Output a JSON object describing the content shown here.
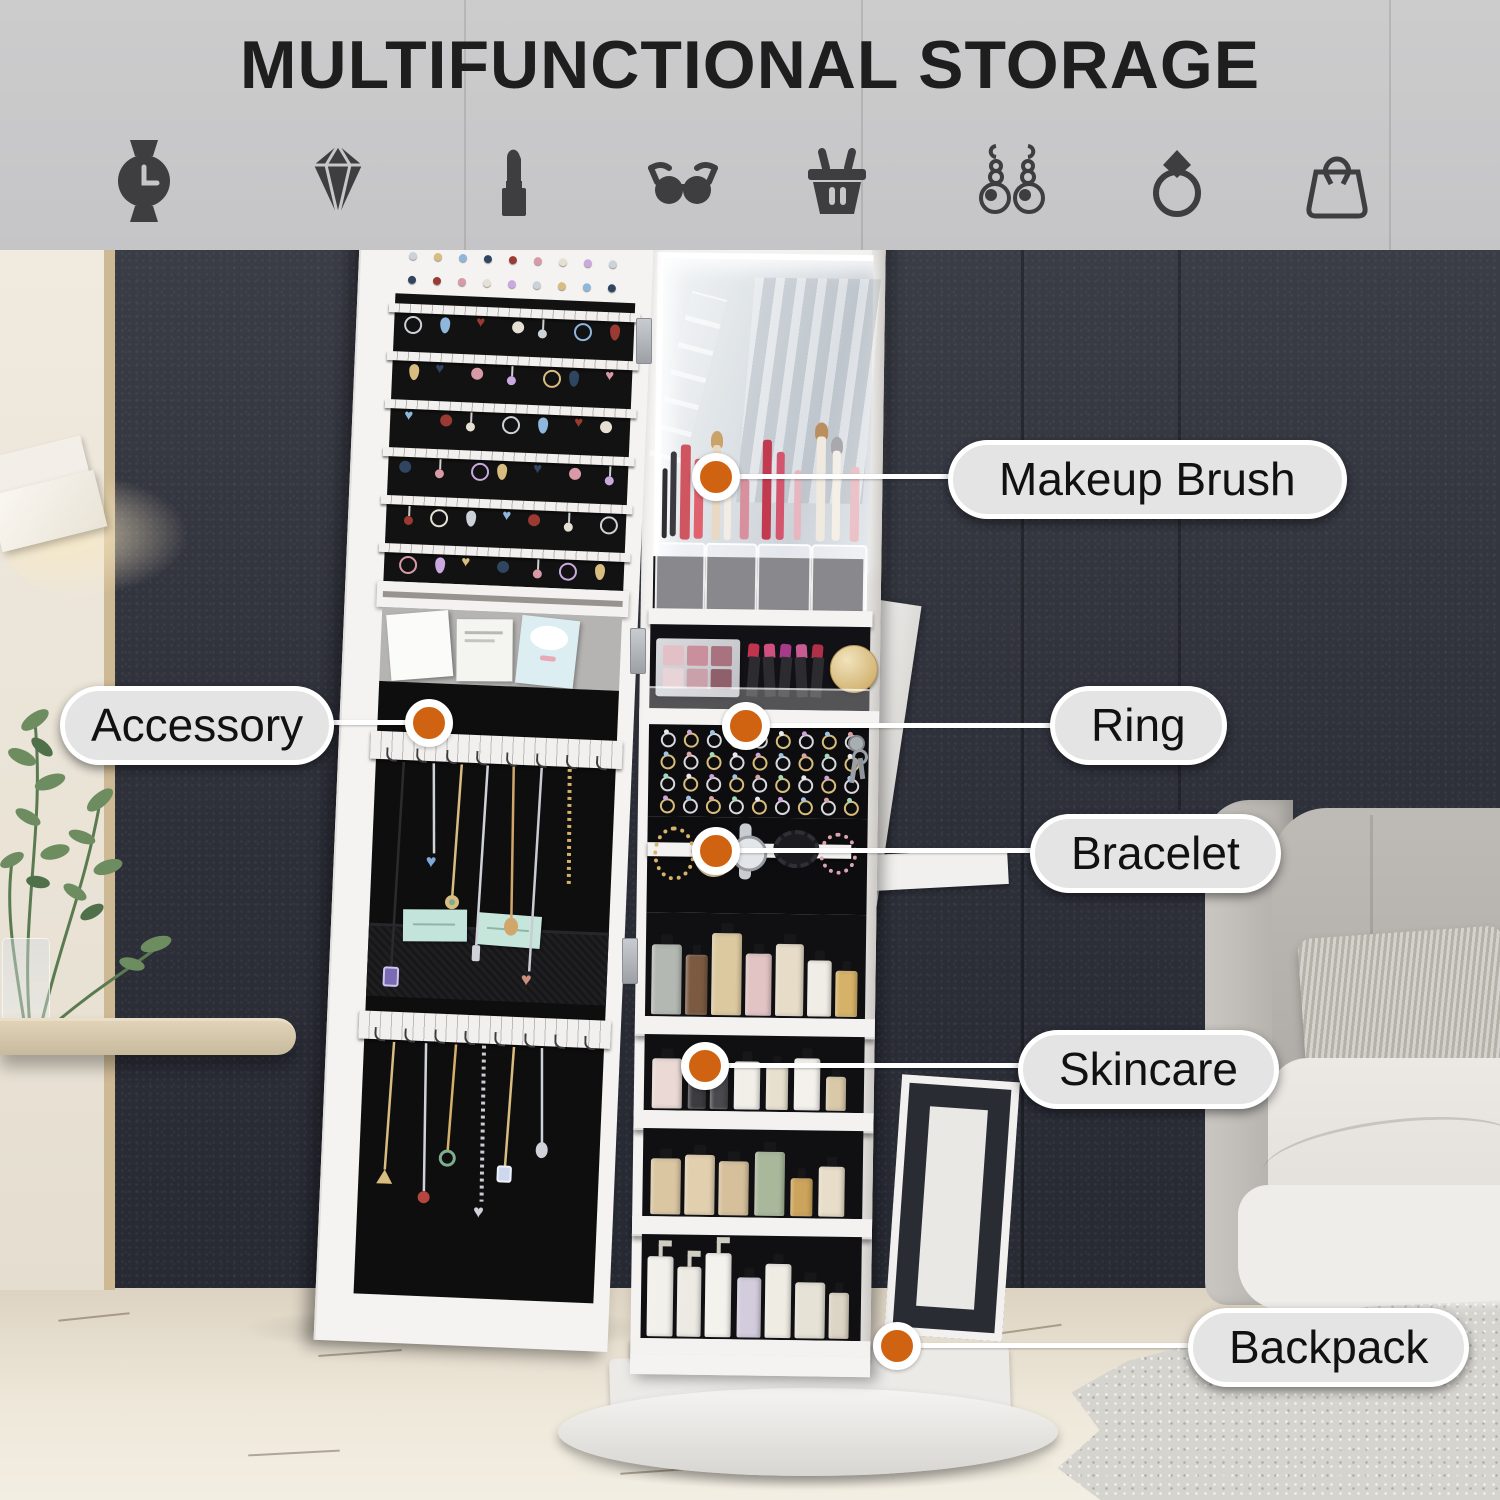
{
  "header": {
    "title": "MULTIFUNCTIONAL STORAGE"
  },
  "icons": [
    "watch",
    "diamond",
    "lipstick",
    "sunglasses",
    "shopping-basket",
    "earrings",
    "ring",
    "handbag"
  ],
  "callouts": {
    "makeup_brush": {
      "label": "Makeup Brush"
    },
    "accessory": {
      "label": "Accessory"
    },
    "ring": {
      "label": "Ring"
    },
    "bracelet": {
      "label": "Bracelet"
    },
    "skincare": {
      "label": "Skincare"
    },
    "backpack": {
      "label": "Backpack"
    }
  },
  "colors": {
    "accent_dot": "#cf6311",
    "pill_bg": "#e4e4e4",
    "banner_bg": "#c9c9ca",
    "wall_dark": "#30323d"
  }
}
